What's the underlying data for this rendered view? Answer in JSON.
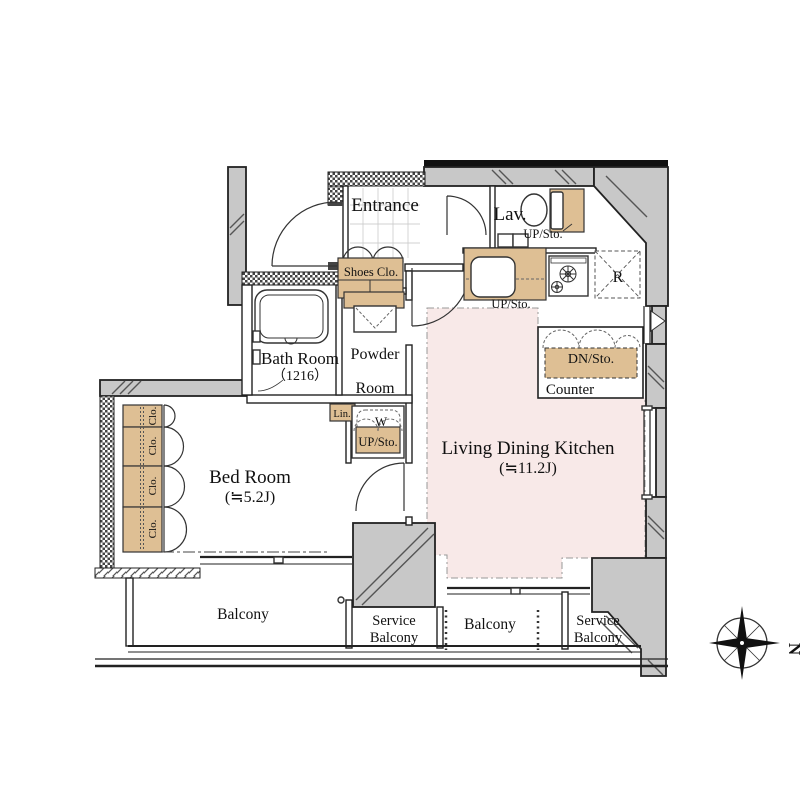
{
  "plan": {
    "rooms": {
      "entrance": "Entrance",
      "lav": "Lav.",
      "bath_room": "Bath Room",
      "bath_size": "（1216）",
      "powder_line1": "Powder",
      "powder_line2": "Room",
      "bed_room": "Bed Room",
      "bed_size": "(≒5.2J)",
      "ldk": "Living Dining Kitchen",
      "ldk_size": "(≒11.2J)"
    },
    "storage": {
      "shoes": "Shoes Clo.",
      "up_sto": "UP/Sto.",
      "dn_sto": "DN/Sto.",
      "linen": "Lin.",
      "closet": "Clo.",
      "washer": "W",
      "counter": "Counter",
      "refrigerator": "R"
    },
    "outdoor": {
      "balcony": "Balcony",
      "service_line1": "Service",
      "service_line2": "Balcony"
    },
    "compass": {
      "north": "N"
    },
    "colors": {
      "storage_fill": "#debf94",
      "ldk_fill": "#f8e9e8",
      "wall_fill": "#c8c8c8",
      "line": "#1a1a1a"
    }
  }
}
